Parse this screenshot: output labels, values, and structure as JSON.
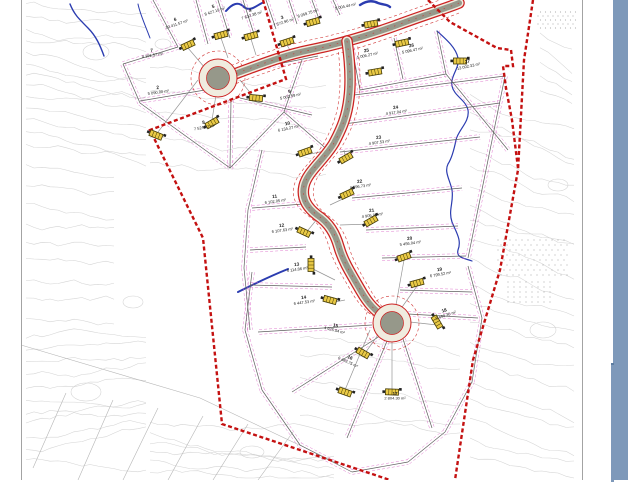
{
  "window": {
    "scrollbar_color": "#7e99ba",
    "scrollbar_seam_color": "#5d7da1",
    "sheet_frame_color": "#a3a3a3"
  },
  "map": {
    "colors": {
      "boundary": "#c41111",
      "road_fill": "#96988a",
      "road_casing": "#f0ecdf",
      "road_edge": "#cc2222",
      "lot_line": "#5f5f5f",
      "setback": "#d95fc4",
      "contour": "#d2d2d2",
      "stream": "#2b3cb0",
      "survey": "#b5b5b5",
      "symbol_fill": "#e9c945",
      "symbol_stroke": "#433a05",
      "label": "#1c1c1c",
      "dots": "#999999",
      "stub": "#8a8a8a"
    },
    "lots": [
      {
        "n": "6",
        "a": "10 411.57 m²",
        "x": 176,
        "y": 22,
        "r": -18
      },
      {
        "n": "5",
        "a": "8 427.19 m²",
        "x": 214,
        "y": 9,
        "r": -18
      },
      {
        "n": "4",
        "a": "7 632.38 m²",
        "x": 251,
        "y": 13,
        "r": -18
      },
      {
        "n": "3",
        "a": "7 572.96 m²",
        "x": 283,
        "y": 20,
        "r": -18
      },
      {
        "n": "",
        "a": "8 059.75 m²",
        "x": 307,
        "y": 11,
        "r": -18
      },
      {
        "n": "",
        "a": "5 004.44 m²",
        "x": 345,
        "y": 4,
        "r": -12
      },
      {
        "n": "25",
        "a": "5 006.27 m²",
        "x": 367,
        "y": 53,
        "r": -12
      },
      {
        "n": "26",
        "a": "5 096.47 m²",
        "x": 412,
        "y": 48,
        "r": -12
      },
      {
        "n": "27",
        "a": "13 002.33 m²",
        "x": 468,
        "y": 64,
        "r": -12
      },
      {
        "n": "7",
        "a": "4 191.57 m²",
        "x": 152,
        "y": 53,
        "r": -8
      },
      {
        "n": "2",
        "a": "5 090.00 m²",
        "x": 158,
        "y": 90,
        "r": -8
      },
      {
        "n": "9",
        "a": "5 002.59 m²",
        "x": 290,
        "y": 94,
        "r": -12
      },
      {
        "n": "8",
        "a": "7 524.57 m²",
        "x": 204,
        "y": 125,
        "r": -10
      },
      {
        "n": "10",
        "a": "6 134.27 m²",
        "x": 288,
        "y": 126,
        "r": -12
      },
      {
        "n": "24",
        "a": "4 917.04 m²",
        "x": 396,
        "y": 110,
        "r": -8
      },
      {
        "n": "23",
        "a": "4 907.53 m²",
        "x": 379,
        "y": 140,
        "r": -8
      },
      {
        "n": "22",
        "a": "4 896.73 m²",
        "x": 360,
        "y": 184,
        "r": -8
      },
      {
        "n": "21",
        "a": "4 905.00 m²",
        "x": 372,
        "y": 213,
        "r": -8
      },
      {
        "n": "11",
        "a": "6 102.05 m²",
        "x": 275,
        "y": 199,
        "r": -8
      },
      {
        "n": "12",
        "a": "6 107.63 m²",
        "x": 282,
        "y": 228,
        "r": -8
      },
      {
        "n": "13",
        "a": "6 114.86 m²",
        "x": 297,
        "y": 267,
        "r": -8
      },
      {
        "n": "14",
        "a": "6 447.53 m²",
        "x": 304,
        "y": 300,
        "r": -8
      },
      {
        "n": "20",
        "a": "5 456.04 m²",
        "x": 410,
        "y": 241,
        "r": -8
      },
      {
        "n": "19",
        "a": "6 799.52 m²",
        "x": 440,
        "y": 272,
        "r": -10
      },
      {
        "n": "18",
        "a": "5 490.30 m²",
        "x": 445,
        "y": 313,
        "r": -18
      },
      {
        "n": "15",
        "a": "4 925.54 m²",
        "x": 335,
        "y": 328,
        "r": 14
      },
      {
        "n": "16",
        "a": "6 483.75 m²",
        "x": 349,
        "y": 360,
        "r": 25
      },
      {
        "n": "17",
        "a": "2 804.30 m²",
        "x": 395,
        "y": 396,
        "r": 0
      }
    ],
    "boundary_paths": [
      "M263,0 L286,79 L150,130 L203,238 L222,424 L390,480",
      "M533,0 L524,60 L518,170 L500,270 L473,360 L455,480",
      "M428,0 L450,22 L497,48 L511,50 L513,66 L503,66 L506,88 L512,120 L518,168"
    ],
    "roads": {
      "paths": [
        "M459,3 C450,7 430,13 400,24 C370,35 340,44 310,50 C285,55 262,64 240,72 L230,76",
        "M347,41 C350,62 351,82 349,98 C347,116 342,128 334,143 C324,160 307,172 304,186 C301,199 308,208 317,215 C329,223 335,233 339,247 C343,261 350,272 361,291 C369,305 376,311 383,316"
      ],
      "setback_offsets": [
        [
          [
            0,
            -10
          ],
          [
            0,
            10
          ]
        ],
        [
          [
            -10,
            0
          ],
          [
            10,
            0
          ]
        ]
      ],
      "culdesacs": [
        {
          "x": 218,
          "y": 78,
          "r_outer": 19,
          "r_inner": 11.5,
          "r_setback": 27
        },
        {
          "x": 392,
          "y": 323,
          "r_outer": 19,
          "r_inner": 11.5,
          "r_setback": 27
        }
      ]
    },
    "streams": [
      {
        "d": "M70,4 C74,14 78,18 88,28 C96,36 100,45 104,56",
        "w": 1.4
      },
      {
        "d": "M138,4 C140,14 144,22 150,38",
        "w": 1.0
      },
      {
        "d": "M226,11 C232,4 238,1 244,7 C250,12 256,6 262,3",
        "w": 2.0
      },
      {
        "d": "M360,5 C366,1 372,0 378,3 C383,5 387,4 390,7",
        "w": 2.4
      },
      {
        "d": "M437,31 C447,40 456,48 458,58 C460,68 450,76 452,86 C454,96 466,100 468,110 C470,122 458,130 456,140 C454,150 452,158 448,164 C444,172 450,180 452,190 C454,202 448,210 452,222 C456,232 462,240 458,250 C456,258 464,258 472,261",
        "w": 1.2
      },
      {
        "d": "M238,292 C252,285 268,277 288,269",
        "w": 2.0
      }
    ],
    "lot_lines": [
      [
        153,
        0,
        178,
        47
      ],
      [
        196,
        0,
        208,
        44
      ],
      [
        218,
        0,
        230,
        38
      ],
      [
        243,
        0,
        254,
        34
      ],
      [
        266,
        0,
        276,
        29
      ],
      [
        289,
        0,
        297,
        24
      ],
      [
        312,
        0,
        319,
        19
      ],
      [
        333,
        0,
        340,
        15
      ],
      [
        178,
        47,
        123,
        64
      ],
      [
        123,
        64,
        140,
        103
      ],
      [
        140,
        103,
        230,
        168
      ],
      [
        230,
        168,
        284,
        112
      ],
      [
        284,
        112,
        302,
        60
      ],
      [
        205,
        90,
        140,
        101
      ],
      [
        231,
        100,
        230,
        168
      ],
      [
        240,
        98,
        312,
        115
      ],
      [
        248,
        70,
        318,
        56
      ],
      [
        284,
        112,
        330,
        152
      ],
      [
        352,
        48,
        360,
        90
      ],
      [
        394,
        38,
        403,
        79
      ],
      [
        437,
        31,
        446,
        74
      ],
      [
        360,
        90,
        446,
        74
      ],
      [
        446,
        74,
        508,
        150
      ],
      [
        346,
        96,
        505,
        76
      ],
      [
        344,
        124,
        500,
        103
      ],
      [
        340,
        152,
        480,
        137
      ],
      [
        352,
        198,
        462,
        188
      ],
      [
        366,
        230,
        458,
        226
      ],
      [
        382,
        258,
        466,
        256
      ],
      [
        400,
        290,
        472,
        292
      ],
      [
        408,
        314,
        478,
        318
      ],
      [
        505,
        76,
        486,
        170
      ],
      [
        486,
        170,
        468,
        258
      ],
      [
        252,
        208,
        303,
        204
      ],
      [
        250,
        250,
        306,
        247
      ],
      [
        250,
        285,
        332,
        287
      ],
      [
        262,
        150,
        248,
        210
      ],
      [
        248,
        210,
        244,
        268
      ],
      [
        244,
        268,
        250,
        330
      ],
      [
        372,
        325,
        258,
        332
      ],
      [
        380,
        336,
        292,
        392
      ],
      [
        387,
        341,
        347,
        438
      ],
      [
        403,
        339,
        432,
        428
      ],
      [
        252,
        272,
        245,
        330
      ],
      [
        245,
        330,
        262,
        390
      ],
      [
        262,
        390,
        300,
        445
      ],
      [
        300,
        445,
        352,
        472
      ],
      [
        352,
        472,
        408,
        462
      ],
      [
        408,
        462,
        445,
        432
      ],
      [
        445,
        432,
        472,
        382
      ],
      [
        472,
        382,
        482,
        318
      ],
      [
        482,
        318,
        468,
        266
      ]
    ],
    "symbols": [
      {
        "x": 188,
        "y": 45,
        "rot": -25
      },
      {
        "x": 221,
        "y": 35,
        "rot": -15
      },
      {
        "x": 251,
        "y": 36,
        "rot": -15
      },
      {
        "x": 287,
        "y": 42,
        "rot": -18
      },
      {
        "x": 313,
        "y": 22,
        "rot": -15
      },
      {
        "x": 371,
        "y": 24,
        "rot": -10
      },
      {
        "x": 402,
        "y": 43,
        "rot": -12
      },
      {
        "x": 460,
        "y": 61,
        "rot": 0
      },
      {
        "x": 375,
        "y": 72,
        "rot": -10
      },
      {
        "x": 156,
        "y": 135,
        "rot": 22
      },
      {
        "x": 212,
        "y": 123,
        "rot": -30
      },
      {
        "x": 256,
        "y": 98,
        "rot": 5
      },
      {
        "x": 305,
        "y": 152,
        "rot": -20
      },
      {
        "x": 346,
        "y": 158,
        "rot": -30
      },
      {
        "x": 347,
        "y": 194,
        "rot": -25
      },
      {
        "x": 371,
        "y": 221,
        "rot": -30
      },
      {
        "x": 304,
        "y": 232,
        "rot": 25
      },
      {
        "x": 311,
        "y": 265,
        "rot": 90
      },
      {
        "x": 330,
        "y": 300,
        "rot": 15
      },
      {
        "x": 404,
        "y": 257,
        "rot": -20
      },
      {
        "x": 417,
        "y": 283,
        "rot": -15
      },
      {
        "x": 437,
        "y": 322,
        "rot": 60
      },
      {
        "x": 363,
        "y": 353,
        "rot": 30
      },
      {
        "x": 392,
        "y": 392,
        "rot": 2
      },
      {
        "x": 345,
        "y": 392,
        "rot": 20
      }
    ],
    "stubs": [
      [
        188,
        48,
        205,
        68
      ],
      [
        212,
        120,
        216,
        95
      ],
      [
        158,
        132,
        198,
        80
      ],
      [
        256,
        100,
        240,
        80
      ],
      [
        305,
        155,
        330,
        150
      ],
      [
        346,
        161,
        344,
        150
      ],
      [
        347,
        197,
        330,
        205
      ],
      [
        371,
        224,
        340,
        225
      ],
      [
        304,
        235,
        318,
        218
      ],
      [
        311,
        268,
        335,
        280
      ],
      [
        330,
        303,
        345,
        300
      ],
      [
        404,
        260,
        396,
        305
      ],
      [
        417,
        286,
        400,
        310
      ],
      [
        437,
        325,
        410,
        322
      ],
      [
        363,
        356,
        378,
        335
      ],
      [
        392,
        389,
        392,
        342
      ],
      [
        345,
        390,
        370,
        330
      ],
      [
        221,
        38,
        228,
        58
      ],
      [
        251,
        39,
        256,
        55
      ],
      [
        287,
        45,
        291,
        52
      ]
    ],
    "survey_lines": [
      [
        21,
        345,
        200,
        398
      ],
      [
        200,
        398,
        335,
        462
      ],
      [
        113,
        400,
        78,
        480
      ],
      [
        158,
        408,
        123,
        480
      ],
      [
        203,
        416,
        168,
        480
      ],
      [
        248,
        424,
        213,
        480
      ],
      [
        293,
        432,
        258,
        480
      ],
      [
        66,
        393,
        33,
        468
      ]
    ],
    "contour_regions": [
      {
        "x": 26,
        "y": 2,
        "w": 120,
        "h": 150,
        "n": 13,
        "slant": 0.15
      },
      {
        "x": 26,
        "y": 160,
        "w": 95,
        "h": 170,
        "n": 9,
        "slant": 0.1
      },
      {
        "x": 26,
        "y": 335,
        "w": 120,
        "h": 135,
        "n": 11,
        "slant": -0.1
      },
      {
        "x": 150,
        "y": 420,
        "w": 190,
        "h": 58,
        "n": 6,
        "slant": 0.1
      },
      {
        "x": 470,
        "y": 90,
        "w": 108,
        "h": 180,
        "n": 10,
        "slant": 0.45
      },
      {
        "x": 470,
        "y": 280,
        "w": 108,
        "h": 190,
        "n": 10,
        "slant": 0.35
      },
      {
        "x": 150,
        "y": 60,
        "w": 180,
        "h": 120,
        "n": 5,
        "slant": 0.1
      },
      {
        "x": 300,
        "y": 330,
        "w": 160,
        "h": 100,
        "n": 5,
        "slant": 0.2
      },
      {
        "x": 540,
        "y": 30,
        "w": 38,
        "h": 70,
        "n": 5,
        "slant": 0.8
      }
    ],
    "contour_loops": [
      [
        96,
        52,
        13,
        8
      ],
      [
        133,
        302,
        10,
        6
      ],
      [
        86,
        392,
        15,
        9
      ],
      [
        252,
        452,
        12,
        6
      ],
      [
        543,
        330,
        13,
        8
      ],
      [
        558,
        185,
        10,
        6
      ],
      [
        163,
        44,
        8,
        5
      ]
    ],
    "dot_regions": [
      {
        "x": 538,
        "y": 12,
        "w": 40,
        "h": 20,
        "sx": 5,
        "sy": 4
      },
      {
        "x": 498,
        "y": 240,
        "w": 72,
        "h": 36,
        "sx": 6,
        "sy": 5
      },
      {
        "x": 505,
        "y": 282,
        "w": 48,
        "h": 22,
        "sx": 6,
        "sy": 5
      }
    ]
  }
}
